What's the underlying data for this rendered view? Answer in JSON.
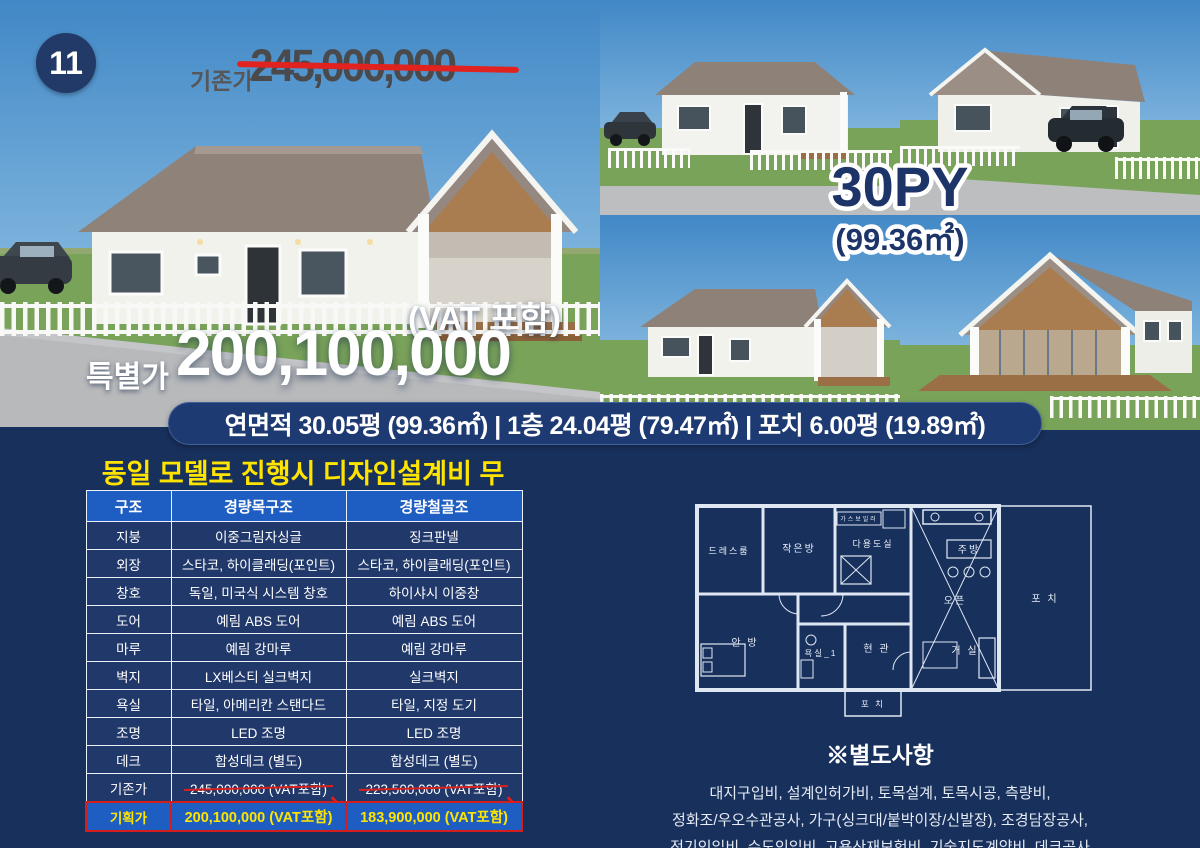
{
  "badge": {
    "number": "11"
  },
  "header": {
    "old_price_label": "기존가",
    "old_price": "245,000,000"
  },
  "hero": {
    "vat_note": "(VAT 포함)",
    "special_label": "특별가",
    "special_price": "200,100,000",
    "model_size": "30PY",
    "model_area": "(99.36㎡)",
    "area_band": "연면적 30.05평 (99.36㎡)  |  1층 24.04평 (79.47㎡)  |  포치 6.00평 (19.89㎡)"
  },
  "promo": {
    "headline": "동일 모델로 진행시 디자인설계비 무료!"
  },
  "spec_table": {
    "headers": [
      "구조",
      "경량목구조",
      "경량철골조"
    ],
    "rows": [
      {
        "label": "지붕",
        "wood": "이중그림자싱글",
        "steel": "징크판넬"
      },
      {
        "label": "외장",
        "wood": "스타코, 하이클래딩(포인트)",
        "steel": "스타코, 하이클래딩(포인트)"
      },
      {
        "label": "창호",
        "wood": "독일, 미국식 시스템 창호",
        "steel": "하이샤시 이중창"
      },
      {
        "label": "도어",
        "wood": "예림 ABS 도어",
        "steel": "예림 ABS 도어"
      },
      {
        "label": "마루",
        "wood": "예림 강마루",
        "steel": "예림 강마루"
      },
      {
        "label": "벽지",
        "wood": "LX베스티 실크벽지",
        "steel": "실크벽지"
      },
      {
        "label": "욕실",
        "wood": "타일, 아메리칸 스탠다드",
        "steel": "타일, 지정 도기"
      },
      {
        "label": "조명",
        "wood": "LED 조명",
        "steel": "LED 조명"
      },
      {
        "label": "데크",
        "wood": "합성데크 (별도)",
        "steel": "합성데크 (별도)"
      }
    ],
    "old_row": {
      "label": "기존가",
      "wood": "245,000,000 (VAT포함)",
      "steel": "223,500,000 (VAT포함)"
    },
    "plan_row": {
      "label": "기획가",
      "wood": "200,100,000 (VAT포함)",
      "steel": "183,900,000 (VAT포함)"
    }
  },
  "floor_plan": {
    "dress_room": "드레스룸",
    "small_room": "작은방",
    "gas_boiler": "가스보일러",
    "utility": "다용도실",
    "kitchen": "주방",
    "open": "오픈",
    "porch_right": "포 치",
    "master": "안 방",
    "bath": "욕실_1",
    "entrance": "현 관",
    "living": "거 실",
    "porch_bottom": "포 치"
  },
  "extras": {
    "title": "※별도사항",
    "lines": [
      "대지구입비, 설계인허가비, 토목설계, 토목시공, 측량비,",
      "정화조/우오수관공사, 가구(싱크대/붙박이장/신발장), 조경담장공사,",
      "전기인입비, 수도인입비, 고용산재보험비, 기술지도계약비, 데크공사"
    ]
  },
  "colors": {
    "navy": "#18305c",
    "accent_blue": "#1e5ec2",
    "yellow": "#ffe400",
    "red": "#d41d1d"
  }
}
